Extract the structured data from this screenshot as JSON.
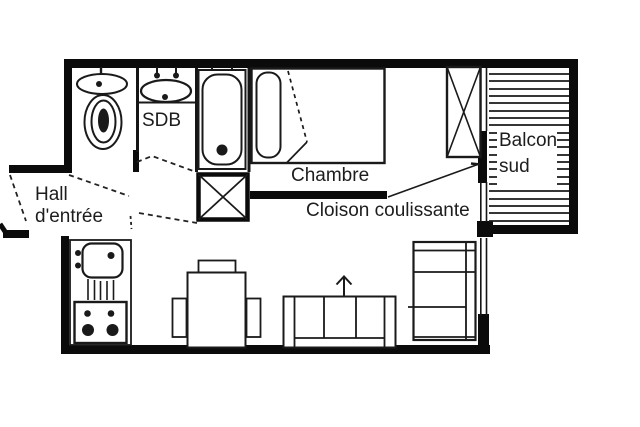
{
  "document": {
    "type": "apartment-floor-plan",
    "background": "#ffffff"
  },
  "colors": {
    "wall": "#0b0b0b",
    "ink": "#1a1a1a",
    "text": "#1d1d1d",
    "background": "#ffffff"
  },
  "labels": {
    "bathroom": "SDB",
    "hall_line1": "Hall",
    "hall_line2": "d'entrée",
    "bedroom": "Chambre",
    "sliding_partition": "Cloison coulissante",
    "balcony_line1": "Balcon",
    "balcony_line2": "sud"
  }
}
